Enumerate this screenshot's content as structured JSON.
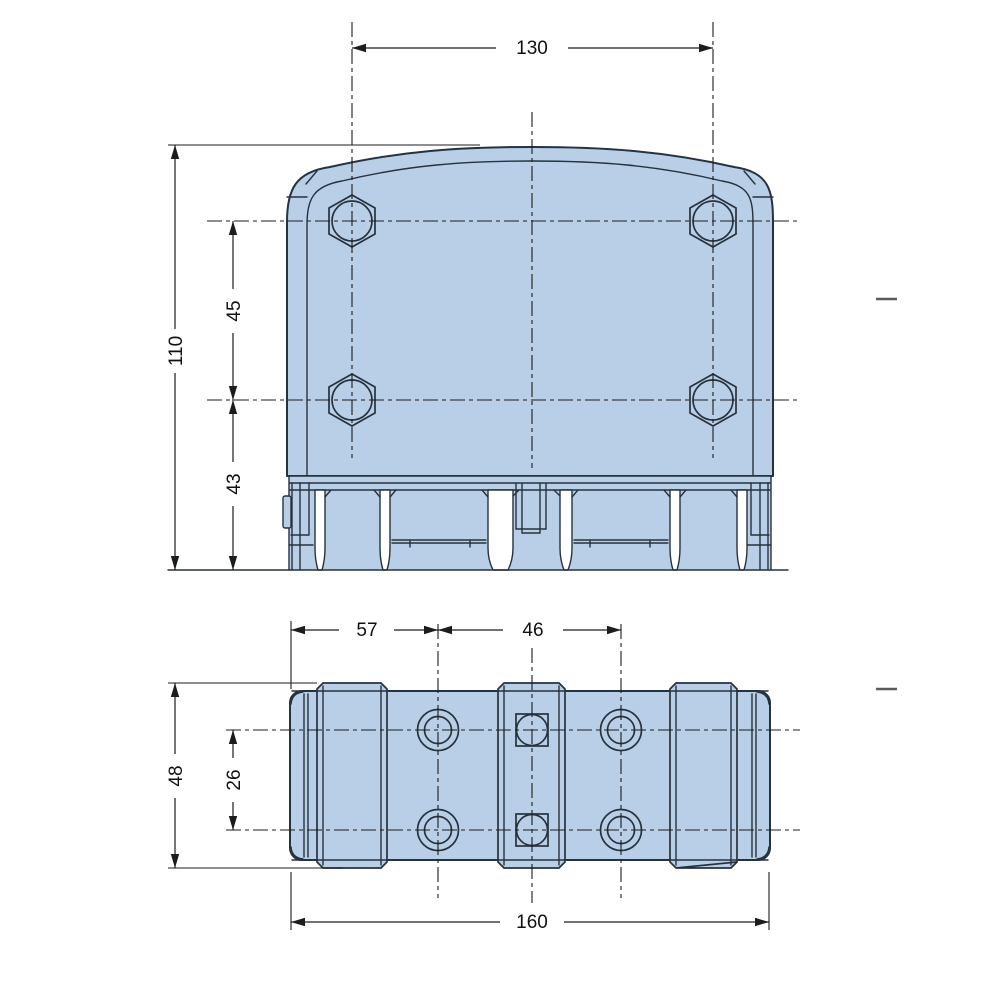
{
  "front_view": {
    "width": "130",
    "overall_height": "110",
    "bolt_row_spacing": "45",
    "base_height": "43"
  },
  "bottom_view": {
    "end_to_port": "57",
    "port_column_spacing": "46",
    "overall_depth": "48",
    "port_row_spacing": "26",
    "overall_length": "160"
  },
  "colors": {
    "part_fill": "#b9cfe7",
    "part_line": "#26323e",
    "dimension_line": "#1c1c1c",
    "reference_dash": "#5a5a5a",
    "background": "#ffffff"
  }
}
